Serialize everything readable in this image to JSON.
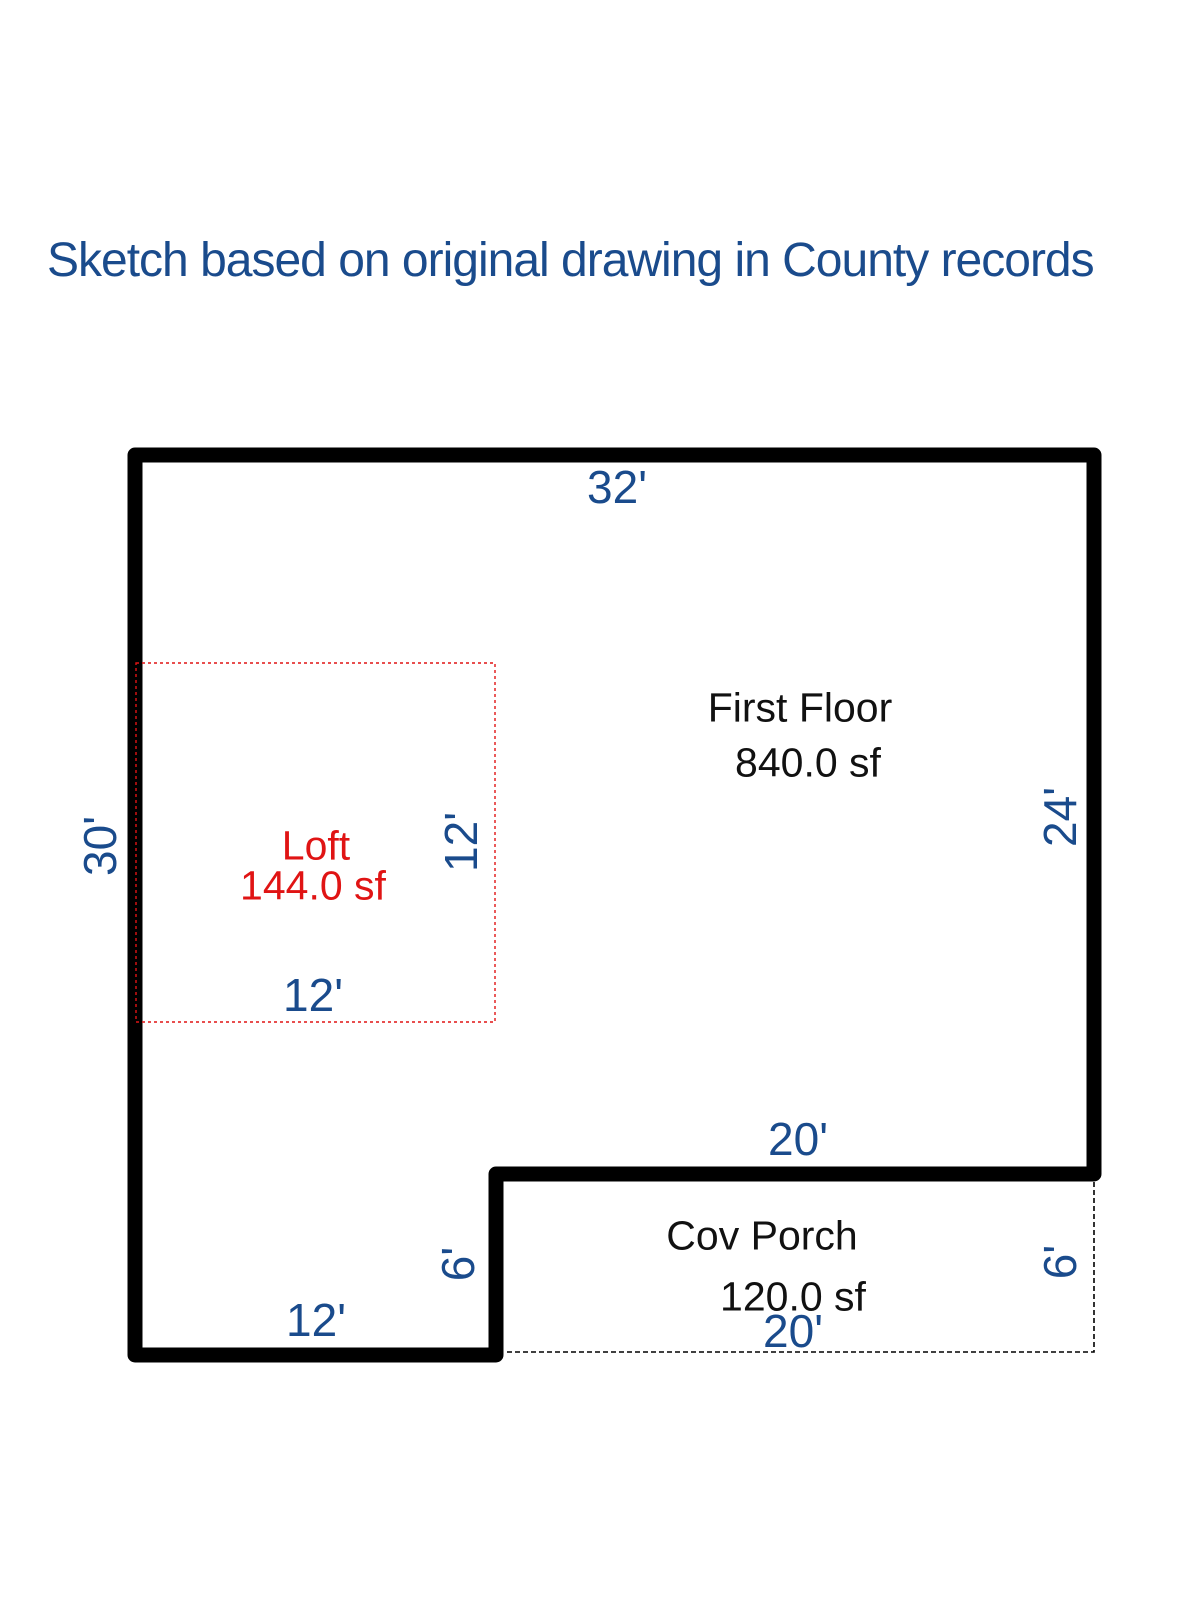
{
  "page": {
    "title": "Sketch based on original drawing in County records"
  },
  "colors": {
    "dimension_blue": "#1a4b8c",
    "loft_red": "#e01414",
    "wall_black": "#000000",
    "room_text_black": "#111111"
  },
  "rooms": {
    "first_floor": {
      "name": "First Floor",
      "area": "840.0 sf"
    },
    "loft": {
      "name": "Loft",
      "area": "144.0 sf"
    },
    "cov_porch": {
      "name": "Cov Porch",
      "area": "120.0 sf"
    }
  },
  "dimensions": {
    "house_top_width": "32'",
    "house_left_height": "30'",
    "house_right_height": "24'",
    "loft_height": "12'",
    "loft_width": "12'",
    "porch_top_width": "20'",
    "porch_bottom_width": "20'",
    "porch_inner_height": "6'",
    "porch_right_height": "6'",
    "house_bottom_left_width": "12'"
  }
}
